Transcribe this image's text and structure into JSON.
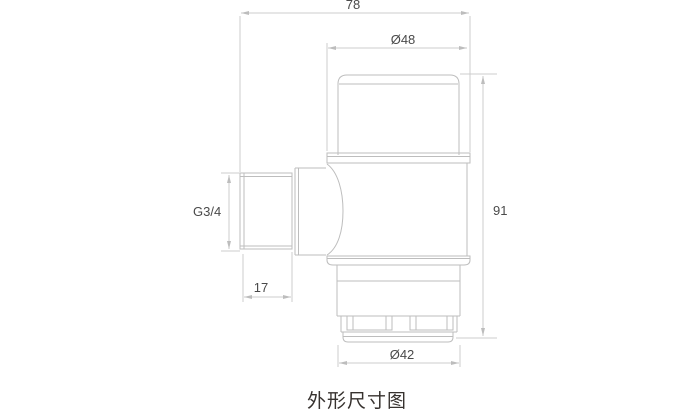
{
  "caption": "外形尺寸图",
  "drawing": {
    "description": "valve-outline-dimension-drawing",
    "dimensions": {
      "overall_width": "78",
      "head_diameter": "Ø48",
      "inlet_thread": "G3/4",
      "thread_length": "17",
      "overall_height": "91",
      "bottom_diameter": "Ø42"
    },
    "colors": {
      "object_line": "#bdbdbd",
      "dimension_line": "#cccccc",
      "dimension_text": "#4a4a4a",
      "caption_text": "#37322f",
      "background": "#ffffff"
    }
  }
}
